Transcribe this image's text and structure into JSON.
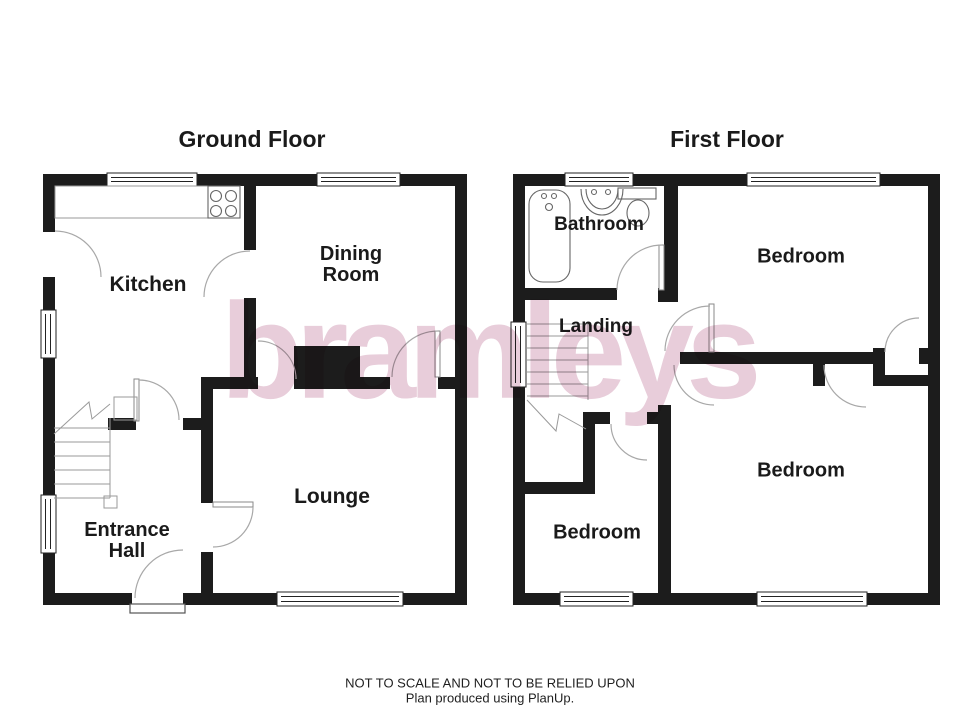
{
  "titles": {
    "ground_floor": "Ground Floor",
    "first_floor": "First Floor"
  },
  "rooms": {
    "kitchen": "Kitchen",
    "dining_line1": "Dining",
    "dining_line2": "Room",
    "lounge": "Lounge",
    "entrance_line1": "Entrance",
    "entrance_line2": "Hall",
    "bathroom": "Bathroom",
    "landing": "Landing",
    "bedroom_first_top": "Bedroom",
    "bedroom_first_left": "Bedroom",
    "bedroom_first_right": "Bedroom"
  },
  "watermark": {
    "text": "bramleys"
  },
  "footer": {
    "line1": "NOT TO SCALE AND NOT TO BE RELIED UPON",
    "line2": "Plan produced using PlanUp."
  },
  "colors": {
    "wall": "#1c1c1c",
    "thin_line": "#9a9a9a",
    "fixture_line": "#666666",
    "watermark": "#e8cdda"
  }
}
